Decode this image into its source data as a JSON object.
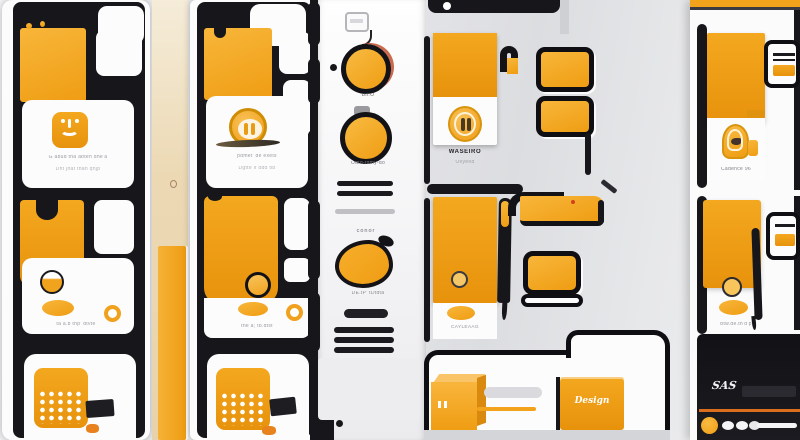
{
  "palette": {
    "amber": "#F2A41F",
    "amber_light": "#F8C45C",
    "amber_dark": "#DE8D10",
    "ink_black": "#17171B",
    "card_white": "#FCFCFD",
    "bg_gray": "#E3E4E7",
    "beige": "#EAD6B0",
    "accent_orange": "#D96F1E"
  },
  "phone1": {
    "screen1": {
      "icon": "sprout-face-app-icon",
      "caption1": "G abud tha abteh dhe'a",
      "caption2": "Dnt jhat thah qhjp"
    },
    "screen2": {
      "caption": "ta a.b thp' dtvte"
    },
    "screen3": {
      "icon": "dots-grid-tile-icon"
    }
  },
  "beige_strip": {
    "mark": "o-ring-mark"
  },
  "phone2": {
    "screen1": {
      "icon": "monogram-ring-icon",
      "caption1": "pdmet' de exets",
      "caption2": "Dgtte if ddd tib"
    },
    "screen2": {
      "caption": "the a; tb.dtst"
    },
    "screen3": {
      "icon": "dots-grid-tile-icon"
    }
  },
  "panel3": {
    "top_icon": "window-icon",
    "labels": {
      "knob1": "Bn.O",
      "knob2": "Odtd-tdmy-do",
      "section": "conor",
      "blob": "DE.tP' tDtdta"
    }
  },
  "panel4": {
    "card": {
      "icon": "badge-oval-icon",
      "title": "WASEIRO",
      "subtitle": "Oilyeod"
    },
    "card2": {
      "caption": "CAYLEAAG"
    },
    "folder": {
      "cube_icon": "cube-3d-icon",
      "button_label": "Design"
    }
  },
  "panel5": {
    "card": {
      "icon": "arch-bird-icon",
      "caption": "Cadence 96"
    },
    "card2": {
      "caption": "btw.de.th'd'p"
    },
    "player": {
      "badge": "SAS",
      "dots": "pagination-dots"
    }
  },
  "icons": [
    "sprout-face-app-icon",
    "dots-grid-tile-icon",
    "monogram-ring-icon",
    "window-icon",
    "knob-dial-icon",
    "blob-swatch-icon",
    "badge-oval-icon",
    "arch-bird-icon",
    "cube-3d-icon",
    "card-lines-icon",
    "o-ring-mark",
    "pagination-dots"
  ]
}
